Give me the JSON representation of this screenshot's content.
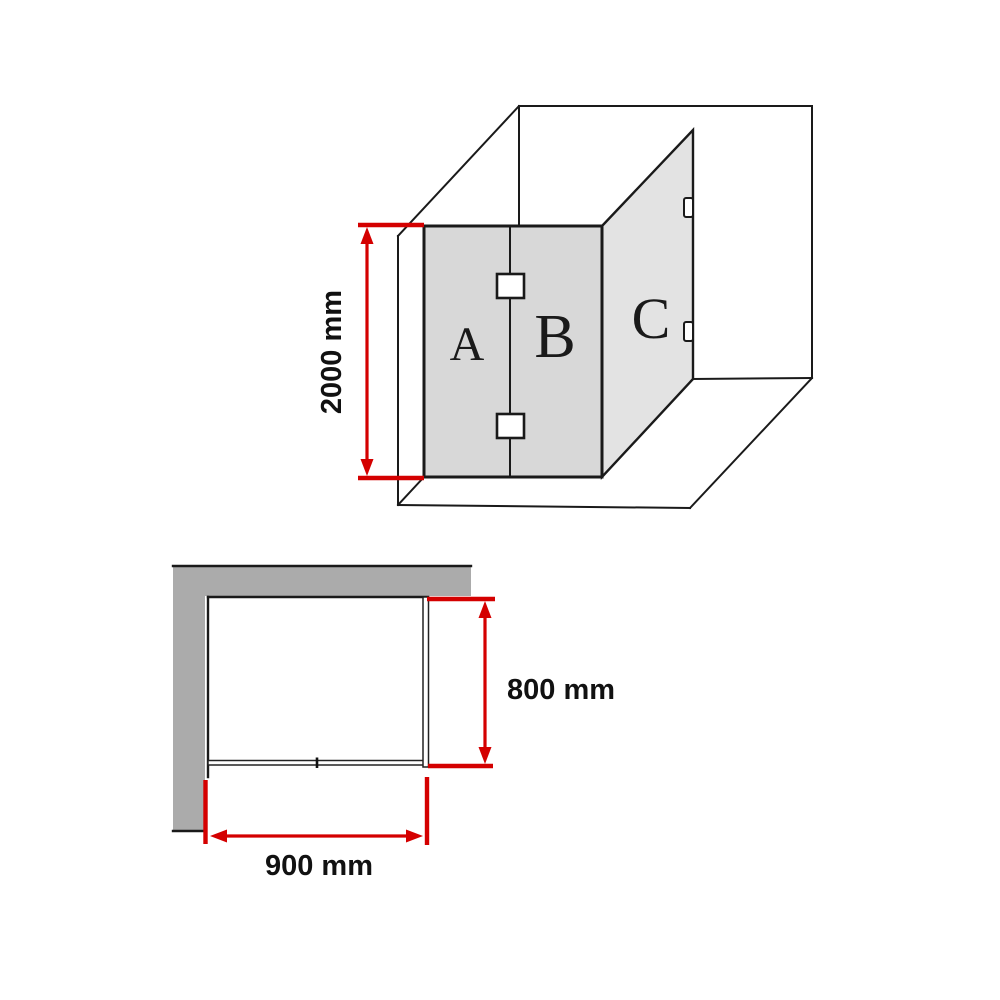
{
  "diagram": {
    "subject": "corner shower screen dimension diagram",
    "views": [
      "isometric",
      "plan"
    ]
  },
  "isometric_view": {
    "panel_labels": {
      "a": "A",
      "b": "B",
      "c": "C"
    },
    "height_dimension": {
      "label": "2000 mm"
    }
  },
  "plan_view": {
    "depth_dimension": {
      "label": "800 mm"
    },
    "width_dimension": {
      "label": "900 mm"
    }
  },
  "colors": {
    "background": "#ffffff",
    "dimension_red": "#d40000",
    "outline_black": "#1a1a1a",
    "panel_ab_fill": "#d8d8d8",
    "panel_c_fill": "#e3e3e3",
    "wall_gray": "#ababab",
    "glass_plan_fill": "#ffffff"
  }
}
